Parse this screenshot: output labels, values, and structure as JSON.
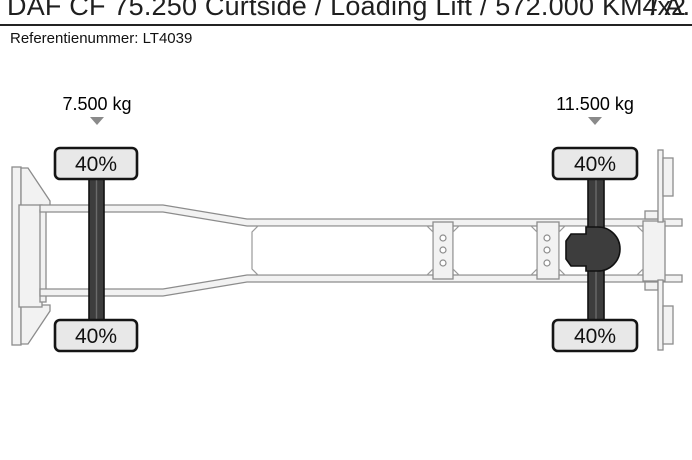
{
  "header": {
    "title": "DAF CF 75.250 Curtside / Loading Lift / 572.000 KM / A...",
    "drivetrain": "4x2",
    "reference_label": "Referentienummer:",
    "reference_value": "LT4039"
  },
  "diagram": {
    "description": "Top view truck chassis axle load distribution",
    "front_axle": {
      "load": "7.500 kg",
      "tire_left_pct": "40%",
      "tire_right_pct": "40%"
    },
    "rear_axle": {
      "load": "11.500 kg",
      "tire_left_pct": "40%",
      "tire_right_pct": "40%"
    },
    "colors": {
      "axle": "#3d3d3d",
      "tire_fill": "#e8e8e8",
      "frame_fill": "#f2f2f2",
      "frame_stroke": "#8c8c8c",
      "marker": "#8a8a8a"
    }
  }
}
